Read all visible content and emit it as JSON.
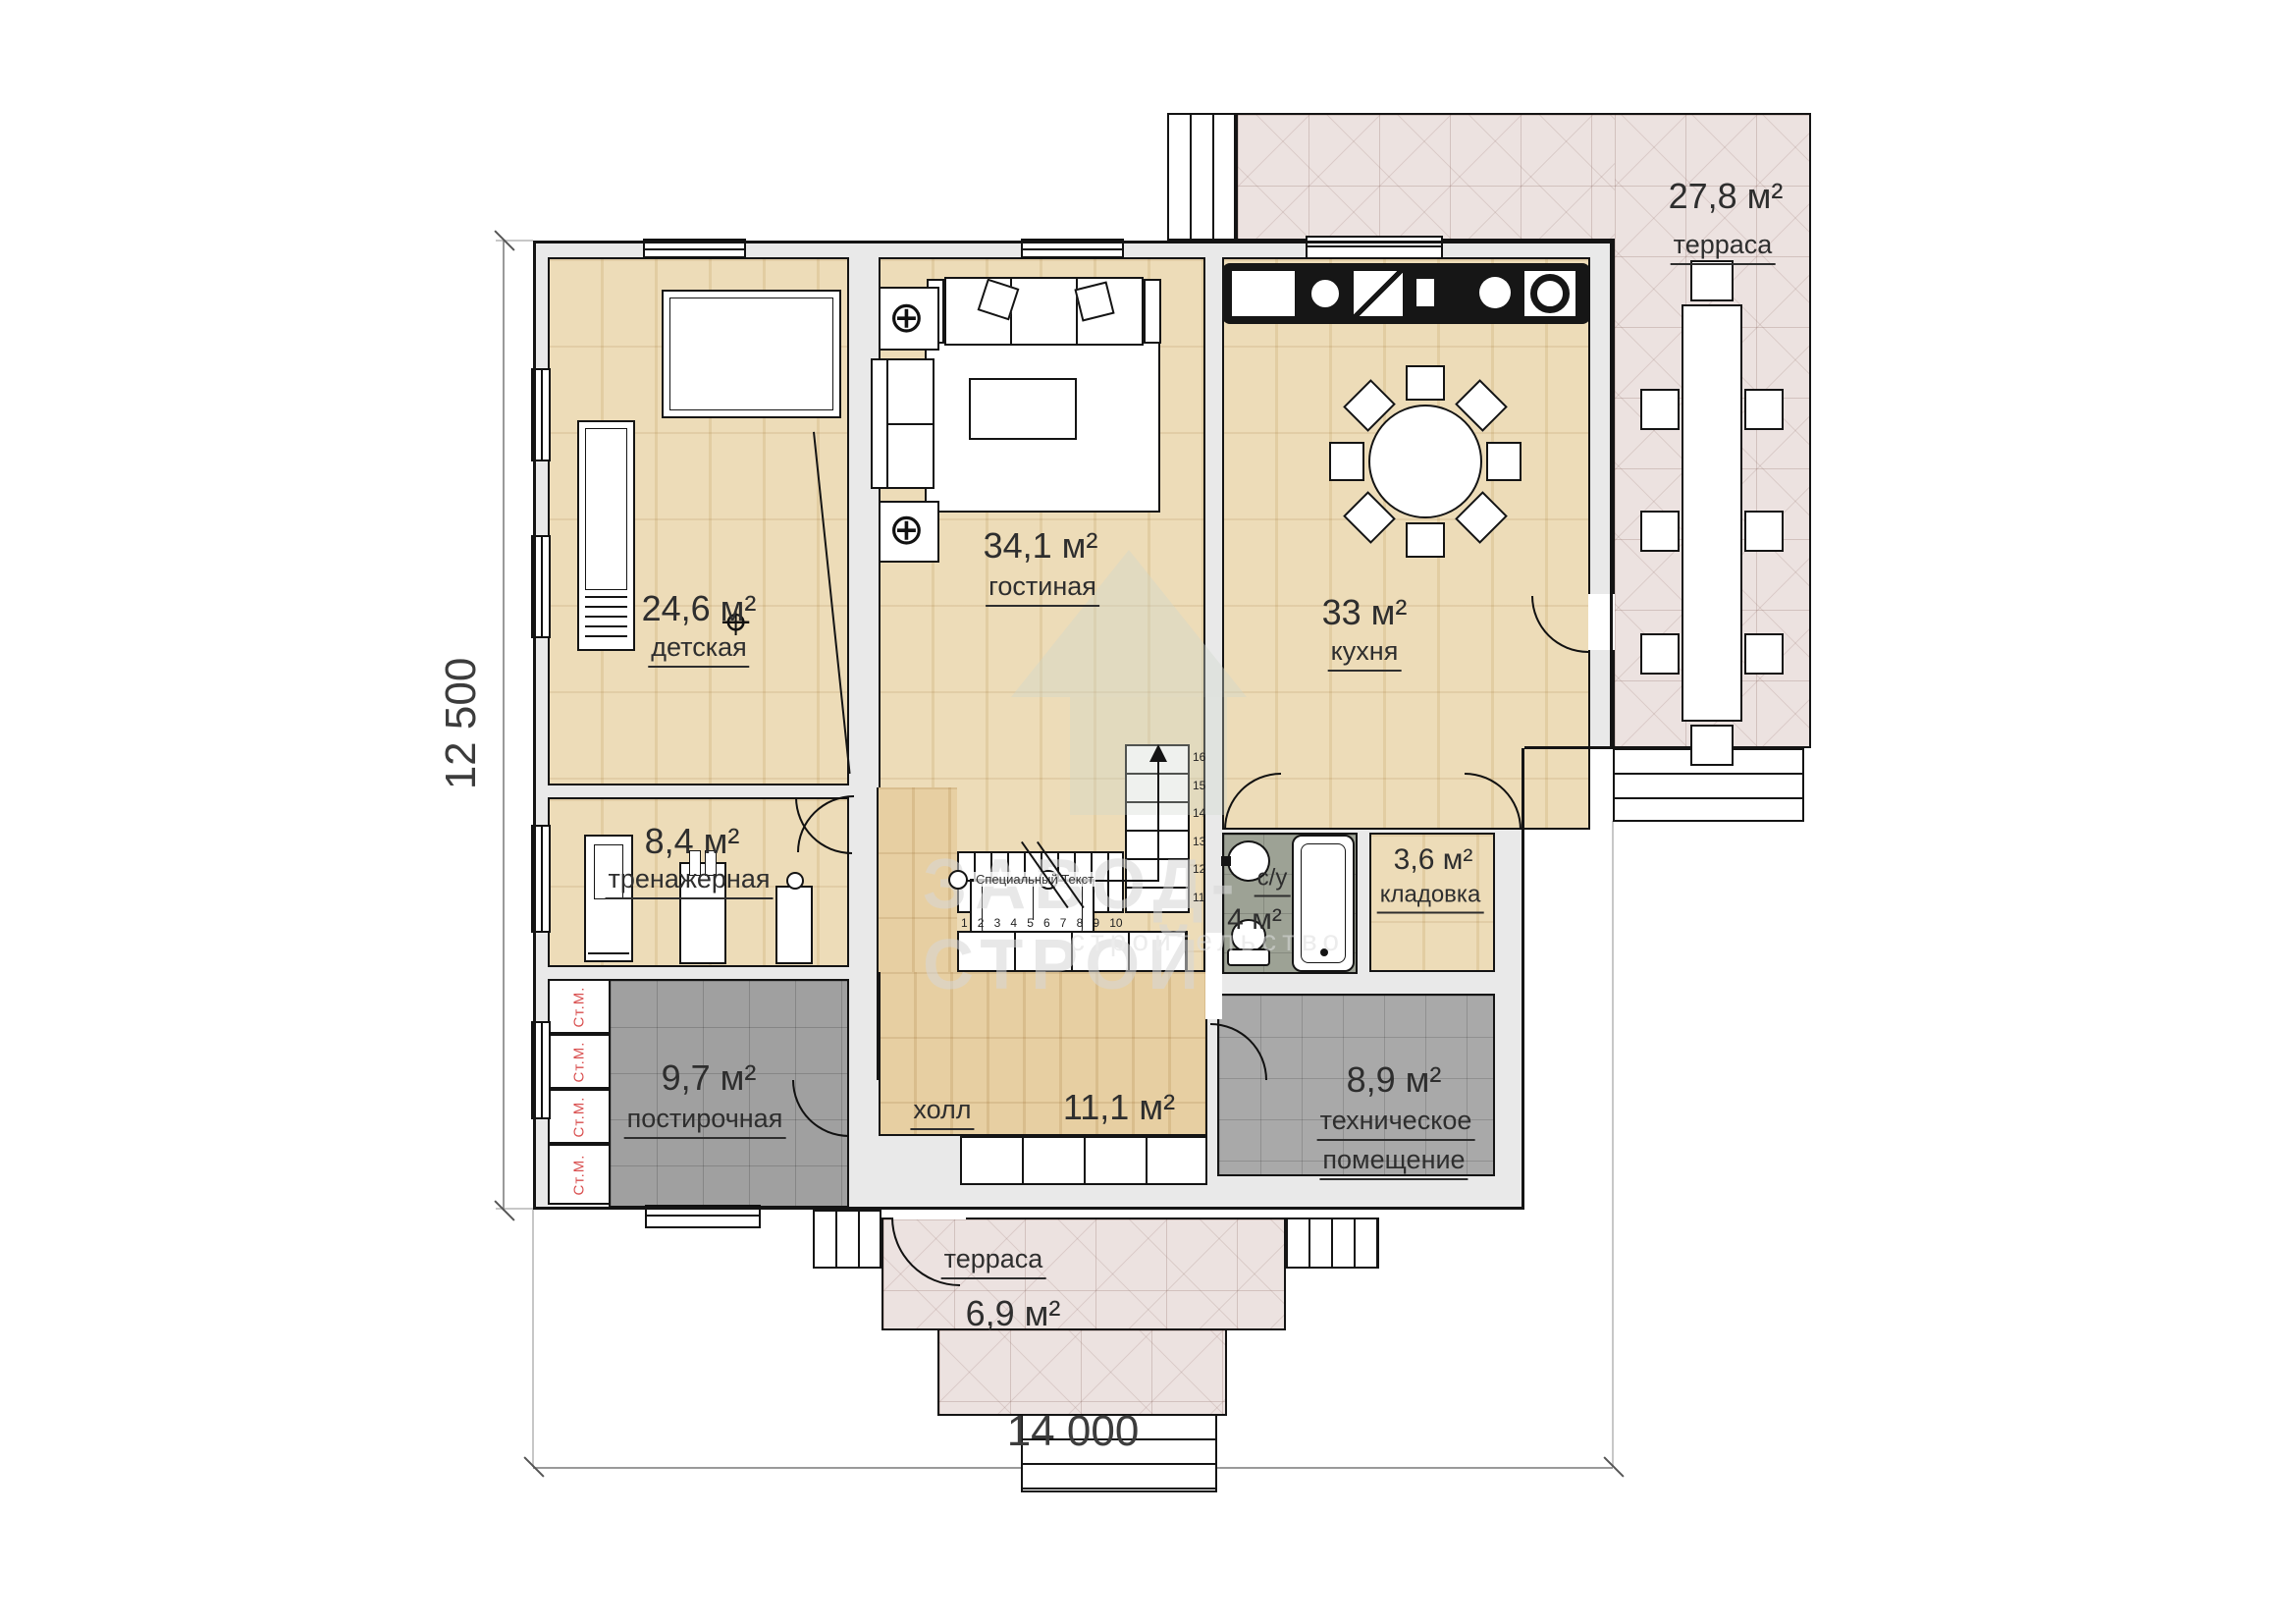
{
  "title": "План 1 этажа",
  "dimensions": {
    "bottom": "14 000",
    "left": "12 500"
  },
  "rooms": {
    "detskaya": {
      "area": "24,6 м²",
      "name": "детская"
    },
    "gostinaya": {
      "area": "34,1 м²",
      "name": "гостиная"
    },
    "kuhnya": {
      "area": "33 м²",
      "name": "кухня"
    },
    "terrasa_top": {
      "area": "27,8 м²",
      "name": "терраса"
    },
    "trenazhernaya": {
      "area": "8,4 м²",
      "name": "тренажерная"
    },
    "kladovka": {
      "area": "3,6 м²",
      "name": "кладовка"
    },
    "sanuzel": {
      "area": "4 м²",
      "name": "с/у"
    },
    "postirochnaya": {
      "area": "9,7 м²",
      "name": "постирочная"
    },
    "holl": {
      "area": "11,1 м²",
      "name": "холл"
    },
    "tehpom": {
      "area": "8,9 м²",
      "name_line1": "техническое",
      "name_line2": "помещение"
    },
    "terrasa_bottom": {
      "area": "6,9 м²",
      "name": "терраса"
    }
  },
  "appliances": {
    "washer": "Ст.М."
  },
  "stairs": {
    "note": "Специальный Текст",
    "lower": [
      "1",
      "2",
      "3",
      "4",
      "5",
      "6",
      "7",
      "8",
      "9",
      "10"
    ],
    "upper": [
      "16",
      "15",
      "14",
      "13",
      "12",
      "11"
    ]
  },
  "watermark": {
    "line1": "ЗАВОД-СТРОЙ",
    "line2": "строительство"
  }
}
